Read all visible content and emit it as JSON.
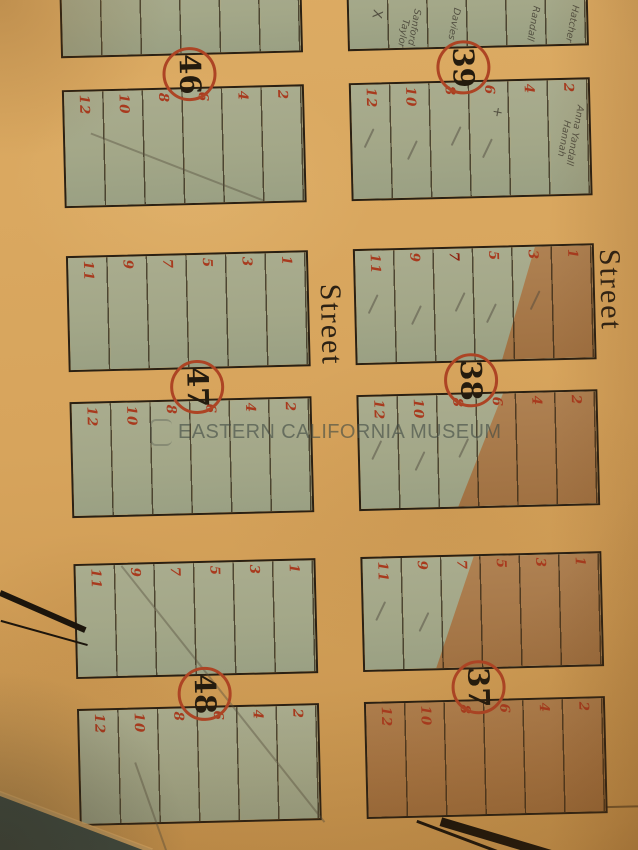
{
  "watermark": {
    "text": "EASTERN CALIFORNIA MUSEUM"
  },
  "street_labels": [
    {
      "text": "Street"
    },
    {
      "text": "Street"
    }
  ],
  "colors": {
    "paper": "#d7a45c",
    "lot_green_wash": "#a5a989",
    "lot_brown_wash": "#a97848",
    "lot_number_red": "#a83a1e",
    "circle_red": "#ad4424",
    "ink_black": "#2a2013",
    "pencil_gray": "#55504a",
    "table_backdrop": "#3c4a42"
  },
  "blocks": [
    {
      "number": "46",
      "tiers": [
        {
          "side": "upper",
          "lots": [
            "",
            "",
            "",
            "",
            "",
            ""
          ],
          "fill": "green",
          "cut_top": true
        },
        {
          "side": "lower",
          "lots": [
            "12",
            "10",
            "8",
            "6",
            "4",
            "2"
          ],
          "fill": "green"
        }
      ]
    },
    {
      "number": "39",
      "tiers": [
        {
          "side": "upper",
          "lots": [
            "",
            "",
            "",
            "",
            "",
            ""
          ],
          "fill": "green",
          "cut_top": true,
          "pencil_notes": [
            {
              "lot": 0,
              "text": "X"
            },
            {
              "lot": 1,
              "text": "Sanford"
            },
            {
              "lot": 1,
              "text": "Taylor"
            },
            {
              "lot": 2,
              "text": "Davies"
            },
            {
              "lot": 4,
              "text": "Randall"
            },
            {
              "lot": 5,
              "text": "Hatcher"
            }
          ]
        },
        {
          "side": "lower",
          "lots": [
            "12",
            "10",
            "8",
            "6",
            "4",
            "2"
          ],
          "fill": "green",
          "checks": [
            0,
            1,
            2,
            3
          ],
          "pencil_notes": [
            {
              "lot": 3,
              "text": "+"
            },
            {
              "lot": 5,
              "text": "Anna Yandall"
            },
            {
              "lot": 5,
              "text": "Hannah"
            }
          ]
        }
      ]
    },
    {
      "number": "47",
      "tiers": [
        {
          "side": "upper",
          "lots": [
            "11",
            "9",
            "7",
            "5",
            "3",
            "1"
          ],
          "fill": "green"
        },
        {
          "side": "lower",
          "lots": [
            "12",
            "10",
            "8",
            "6",
            "4",
            "2"
          ],
          "fill": "green"
        }
      ]
    },
    {
      "number": "38",
      "tiers": [
        {
          "side": "upper",
          "lots": [
            "11",
            "9",
            "7",
            "5",
            "3",
            "1"
          ],
          "fill": "green",
          "checks": [
            0,
            1,
            2,
            3,
            4
          ],
          "bold_lots": [
            2
          ],
          "brown_wedge": {
            "top_pct": 76,
            "bottom_pct": 61
          }
        },
        {
          "side": "lower",
          "lots": [
            "12",
            "10",
            "8",
            "6",
            "4",
            "2"
          ],
          "fill": "green",
          "checks": [
            0,
            1,
            2
          ],
          "brown_wedge": {
            "top_pct": 61,
            "bottom_pct": 41
          }
        }
      ]
    },
    {
      "number": "48",
      "tiers": [
        {
          "side": "upper",
          "lots": [
            "11",
            "9",
            "7",
            "5",
            "3",
            "1"
          ],
          "fill": "green"
        },
        {
          "side": "lower",
          "lots": [
            "12",
            "10",
            "8",
            "6",
            "4",
            "2"
          ],
          "fill": "green"
        }
      ]
    },
    {
      "number": "37",
      "tiers": [
        {
          "side": "upper",
          "lots": [
            "11",
            "9",
            "7",
            "5",
            "3",
            "1"
          ],
          "fill": "green",
          "checks": [
            0,
            1
          ],
          "brown_wedge": {
            "top_pct": 47,
            "bottom_pct": 30
          }
        },
        {
          "side": "lower",
          "lots": [
            "12",
            "10",
            "8",
            "6",
            "4",
            "2"
          ],
          "fill": "brown"
        }
      ]
    }
  ],
  "pencil_lines": [
    {
      "block": "46"
    },
    {
      "block": "48"
    },
    {
      "block": "48b"
    }
  ]
}
